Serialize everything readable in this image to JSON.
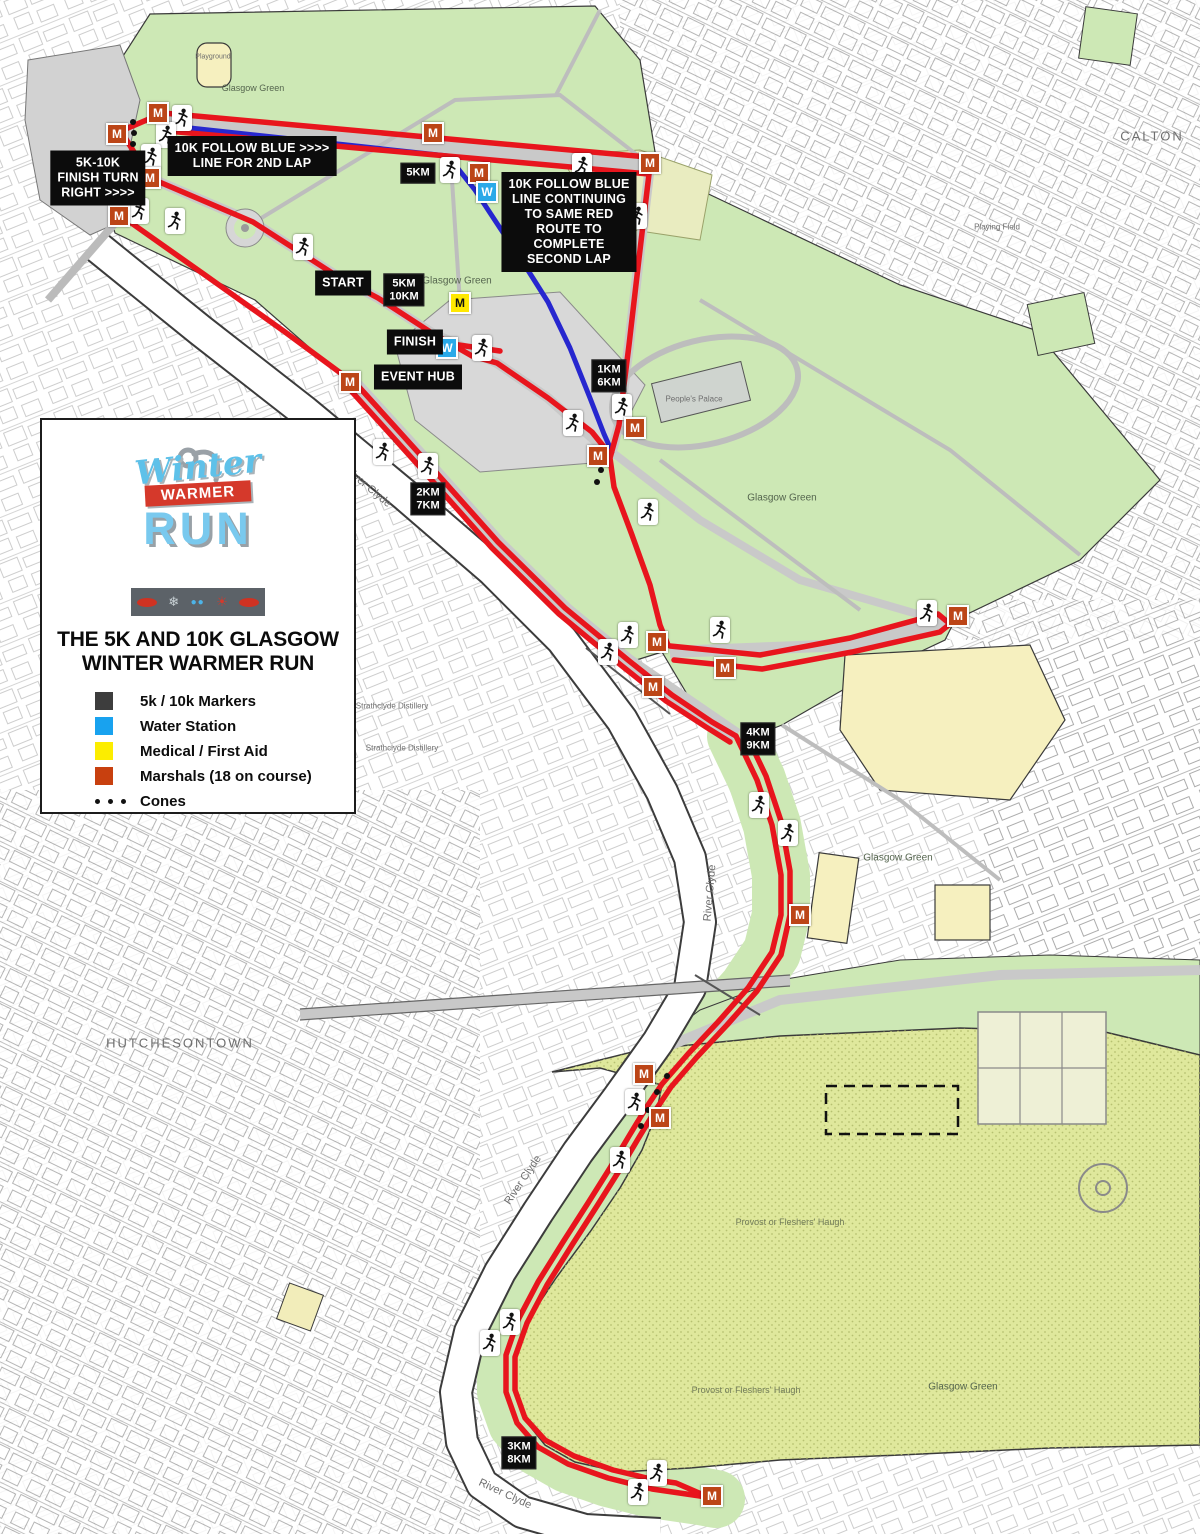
{
  "legend_panel": {
    "logo": {
      "word1": "Winter",
      "word2": "WARMER",
      "word3": "RUN"
    },
    "title_line1": "THE 5K AND 10K GLASGOW",
    "title_line2": "WINTER WARMER RUN",
    "items": [
      {
        "label": "5k / 10k Markers",
        "kind": "square",
        "color": "#3d3d3d"
      },
      {
        "label": "Water Station",
        "kind": "square",
        "color": "#18a2ef"
      },
      {
        "label": "Medical / First Aid",
        "kind": "square",
        "color": "#fced00"
      },
      {
        "label": "Marshals (18 on course)",
        "kind": "square",
        "color": "#c8400f"
      },
      {
        "label": "Cones",
        "kind": "dots",
        "color": "#111111"
      }
    ]
  },
  "map": {
    "marker_letters": {
      "marshal": "M",
      "water": "W",
      "medical": "M"
    },
    "colors": {
      "route_red": "#e8151d",
      "route_blue": "#2727cf",
      "marshal": "#bc4517",
      "water": "#2aa9e8",
      "medical": "#ffe800"
    },
    "callouts": [
      {
        "id": "finish-turn",
        "text": "5K-10K\nFINISH TURN\nRIGHT >>>>",
        "x": 98,
        "y": 178
      },
      {
        "id": "follow-blue-2nd-lap",
        "text": "10K FOLLOW BLUE >>>>\nLINE FOR 2ND LAP",
        "x": 252,
        "y": 156
      },
      {
        "id": "follow-blue-continue",
        "text": "10K FOLLOW BLUE\nLINE CONTINUING\nTO SAME RED\nROUTE TO\nCOMPLETE\nSECOND LAP",
        "x": 569,
        "y": 222
      },
      {
        "id": "start",
        "text": "START",
        "x": 343,
        "y": 283
      },
      {
        "id": "finish",
        "text": "FINISH",
        "x": 415,
        "y": 342
      },
      {
        "id": "event-hub",
        "text": "EVENT HUB",
        "x": 418,
        "y": 377
      }
    ],
    "km_markers": [
      {
        "text": "5KM",
        "x": 418,
        "y": 173
      },
      {
        "text": "5KM\n10KM",
        "x": 404,
        "y": 290
      },
      {
        "text": "1KM\n6KM",
        "x": 609,
        "y": 376
      },
      {
        "text": "2KM\n7KM",
        "x": 428,
        "y": 499
      },
      {
        "text": "4KM\n9KM",
        "x": 758,
        "y": 739
      },
      {
        "text": "3KM\n8KM",
        "x": 519,
        "y": 1453
      }
    ],
    "marshals": [
      [
        158,
        113
      ],
      [
        117,
        134
      ],
      [
        150,
        178
      ],
      [
        119,
        216
      ],
      [
        433,
        133
      ],
      [
        650,
        163
      ],
      [
        479,
        173
      ],
      [
        350,
        382
      ],
      [
        635,
        428
      ],
      [
        598,
        456
      ],
      [
        657,
        642
      ],
      [
        725,
        668
      ],
      [
        653,
        687
      ],
      [
        958,
        616
      ],
      [
        800,
        915
      ],
      [
        644,
        1074
      ],
      [
        660,
        1118
      ],
      [
        712,
        1496
      ]
    ],
    "water_stations": [
      [
        487,
        192
      ],
      [
        447,
        348
      ]
    ],
    "medical": [
      [
        460,
        303
      ]
    ],
    "runners": [
      [
        182,
        118
      ],
      [
        166,
        135
      ],
      [
        151,
        157
      ],
      [
        139,
        211
      ],
      [
        175,
        221
      ],
      [
        450,
        170
      ],
      [
        582,
        166
      ],
      [
        637,
        216
      ],
      [
        303,
        247
      ],
      [
        482,
        348
      ],
      [
        573,
        423
      ],
      [
        622,
        407
      ],
      [
        383,
        452
      ],
      [
        428,
        466
      ],
      [
        648,
        512
      ],
      [
        720,
        630
      ],
      [
        927,
        613
      ],
      [
        628,
        635
      ],
      [
        608,
        652
      ],
      [
        759,
        805
      ],
      [
        788,
        833
      ],
      [
        635,
        1102
      ],
      [
        620,
        1160
      ],
      [
        510,
        1322
      ],
      [
        490,
        1343
      ],
      [
        657,
        1473
      ],
      [
        638,
        1492
      ]
    ],
    "cones": [
      [
        133,
        122
      ],
      [
        134,
        133
      ],
      [
        133,
        144
      ],
      [
        134,
        156
      ],
      [
        133,
        167
      ],
      [
        601,
        470
      ],
      [
        597,
        482
      ],
      [
        667,
        1076
      ],
      [
        657,
        1092
      ],
      [
        648,
        1110
      ],
      [
        641,
        1126
      ]
    ],
    "labels": [
      {
        "text": "Glasgow Green",
        "x": 253,
        "y": 88,
        "s": 9
      },
      {
        "text": "Glasgow Green",
        "x": 457,
        "y": 281,
        "s": 10
      },
      {
        "text": "Glasgow Green",
        "x": 782,
        "y": 498,
        "s": 10
      },
      {
        "text": "Glasgow Green",
        "x": 898,
        "y": 858,
        "s": 10
      },
      {
        "text": "Glasgow Green",
        "x": 963,
        "y": 1387,
        "s": 10
      },
      {
        "text": "People's Palace",
        "x": 694,
        "y": 399,
        "s": 8,
        "c": "#6e6e6e"
      },
      {
        "text": "Provost or Fleshers' Haugh",
        "x": 790,
        "y": 1222,
        "s": 9,
        "c": "#707a58"
      },
      {
        "text": "Provost or Fleshers' Haugh",
        "x": 746,
        "y": 1390,
        "s": 9,
        "c": "#707a58"
      },
      {
        "text": "River Clyde",
        "x": 368,
        "y": 487,
        "s": 11,
        "r": 40,
        "c": "#6e6e6e"
      },
      {
        "text": "River Clyde",
        "x": 710,
        "y": 893,
        "s": 11,
        "r": -85,
        "c": "#6e6e6e"
      },
      {
        "text": "River Clyde",
        "x": 523,
        "y": 1180,
        "s": 11,
        "r": -56,
        "c": "#6e6e6e"
      },
      {
        "text": "River Clyde",
        "x": 505,
        "y": 1494,
        "s": 11,
        "r": 25,
        "c": "#6e6e6e"
      },
      {
        "text": "HUTCHESONTOWN",
        "x": 180,
        "y": 1043,
        "s": 13,
        "sp": 2,
        "c": "#6e6e6e"
      },
      {
        "text": "CALTON",
        "x": 1152,
        "y": 136,
        "s": 13,
        "sp": 2,
        "c": "#6e6e6e"
      },
      {
        "text": "Strathclyde Distillery",
        "x": 392,
        "y": 706,
        "s": 8,
        "c": "#6e6e6e"
      },
      {
        "text": "Strathclyde Distillery",
        "x": 402,
        "y": 748,
        "s": 8,
        "c": "#6e6e6e"
      },
      {
        "text": "Playing Field",
        "x": 997,
        "y": 227,
        "s": 8,
        "c": "#6e6e6e"
      },
      {
        "text": "Playground",
        "x": 213,
        "y": 57,
        "s": 7,
        "c": "#6e6e6e"
      }
    ],
    "route": {
      "red": [
        [
          [
            163,
            113
          ],
          [
            647,
            157
          ]
        ],
        [
          [
            167,
            131
          ],
          [
            649,
            174
          ],
          [
            640,
            250
          ],
          [
            629,
            345
          ],
          [
            619,
            425
          ],
          [
            610,
            458
          ],
          [
            614,
            487
          ],
          [
            632,
            535
          ],
          [
            650,
            585
          ],
          [
            660,
            625
          ],
          [
            668,
            645
          ]
        ],
        [
          [
            163,
            113
          ],
          [
            121,
            131
          ],
          [
            150,
            178
          ],
          [
            120,
            215
          ]
        ],
        [
          [
            120,
            215
          ],
          [
            205,
            275
          ],
          [
            285,
            332
          ],
          [
            350,
            380
          ]
        ],
        [
          [
            150,
            178
          ],
          [
            253,
            222
          ],
          [
            340,
            278
          ],
          [
            378,
            298
          ],
          [
            432,
            333
          ],
          [
            472,
            356
          ],
          [
            497,
            363
          ],
          [
            548,
            398
          ],
          [
            592,
            432
          ],
          [
            608,
            452
          ]
        ],
        [
          [
            500,
            351
          ],
          [
            452,
            344
          ]
        ],
        [
          [
            350,
            377
          ],
          [
            425,
            460
          ],
          [
            498,
            542
          ],
          [
            565,
            608
          ],
          [
            628,
            660
          ],
          [
            672,
            695
          ],
          [
            712,
            722
          ],
          [
            736,
            736
          ]
        ],
        [
          [
            344,
            383
          ],
          [
            419,
            466
          ],
          [
            492,
            548
          ],
          [
            559,
            614
          ],
          [
            622,
            666
          ],
          [
            666,
            701
          ],
          [
            706,
            727
          ],
          [
            730,
            742
          ]
        ],
        [
          [
            670,
            646
          ],
          [
            760,
            655
          ],
          [
            850,
            638
          ],
          [
            938,
            614
          ],
          [
            950,
            624
          ],
          [
            940,
            632
          ],
          [
            852,
            652
          ],
          [
            762,
            669
          ],
          [
            674,
            660
          ]
        ],
        [
          [
            736,
            736
          ],
          [
            757,
            780
          ],
          [
            772,
            825
          ],
          [
            781,
            875
          ],
          [
            781,
            915
          ],
          [
            772,
            952
          ],
          [
            748,
            988
          ],
          [
            718,
            1022
          ],
          [
            688,
            1054
          ],
          [
            662,
            1084
          ],
          [
            646,
            1108
          ],
          [
            629,
            1136
          ],
          [
            610,
            1168
          ],
          [
            588,
            1203
          ],
          [
            563,
            1242
          ],
          [
            538,
            1282
          ],
          [
            518,
            1320
          ],
          [
            506,
            1355
          ],
          [
            506,
            1392
          ],
          [
            517,
            1423
          ],
          [
            538,
            1447
          ],
          [
            568,
            1464
          ],
          [
            608,
            1478
          ],
          [
            652,
            1489
          ],
          [
            700,
            1496
          ],
          [
            716,
            1499
          ]
        ],
        [
          [
            745,
            732
          ],
          [
            766,
            776
          ],
          [
            781,
            821
          ],
          [
            790,
            871
          ],
          [
            790,
            915
          ],
          [
            781,
            955
          ],
          [
            757,
            991
          ],
          [
            727,
            1025
          ],
          [
            697,
            1057
          ],
          [
            671,
            1087
          ],
          [
            655,
            1111
          ],
          [
            638,
            1139
          ],
          [
            619,
            1171
          ],
          [
            597,
            1206
          ],
          [
            572,
            1245
          ],
          [
            547,
            1285
          ],
          [
            527,
            1323
          ],
          [
            515,
            1357
          ],
          [
            515,
            1390
          ],
          [
            525,
            1418
          ],
          [
            545,
            1440
          ],
          [
            574,
            1456
          ],
          [
            613,
            1470
          ],
          [
            655,
            1480
          ],
          [
            676,
            1483
          ],
          [
            706,
            1496
          ]
        ]
      ],
      "blue": [
        [
          [
            172,
            126
          ],
          [
            448,
            156
          ],
          [
            475,
            190
          ],
          [
            500,
            228
          ],
          [
            524,
            264
          ],
          [
            548,
            302
          ],
          [
            570,
            348
          ],
          [
            590,
            398
          ],
          [
            604,
            434
          ],
          [
            612,
            452
          ]
        ]
      ]
    }
  }
}
